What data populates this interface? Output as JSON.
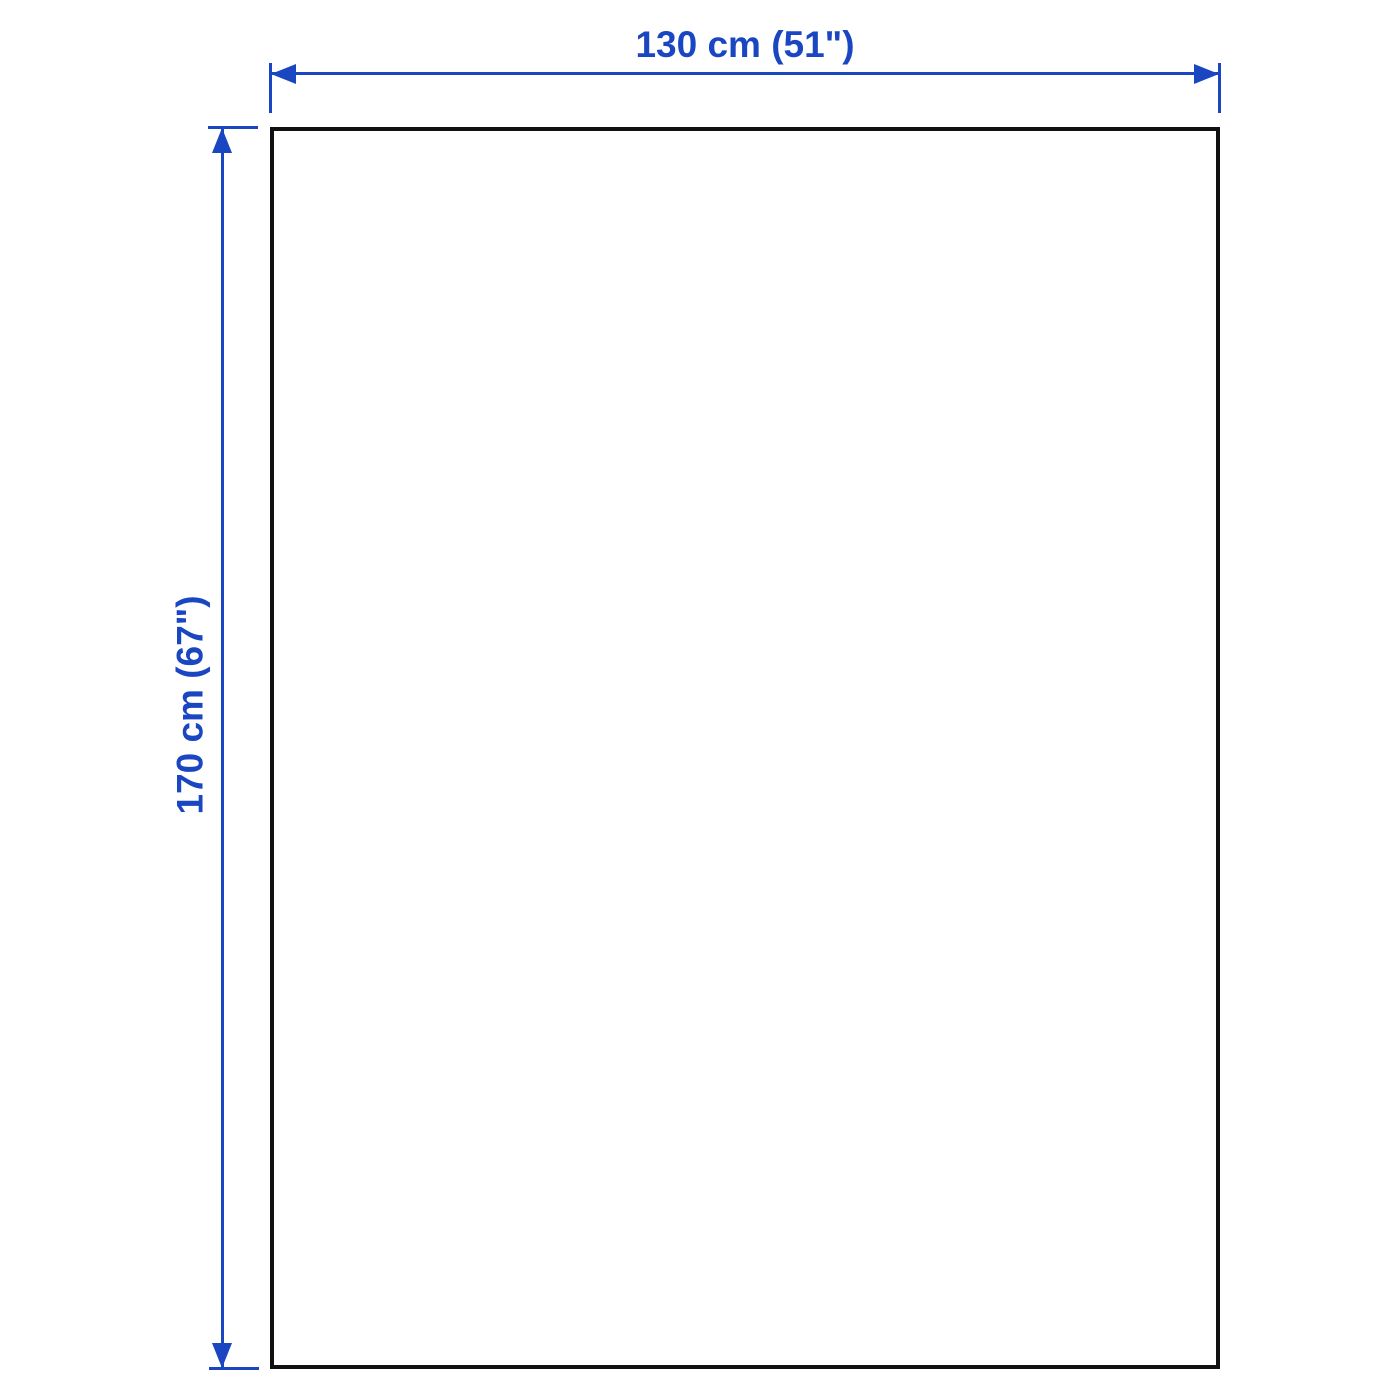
{
  "diagram": {
    "type": "product-dimension-diagram",
    "width_label": "130 cm (51\")",
    "height_label": "170 cm (67\")",
    "colors": {
      "accent": "#1a46c2",
      "outline": "#111111",
      "background": "#ffffff"
    }
  }
}
